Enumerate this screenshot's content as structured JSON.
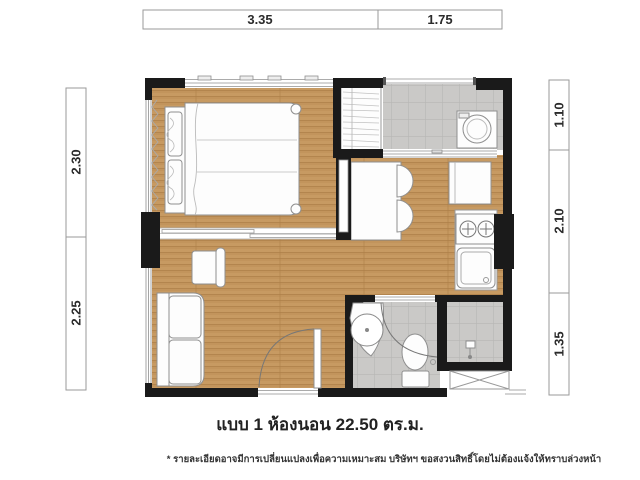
{
  "plan": {
    "title": "แบบ 1 ห้องนอน 22.50 ตร.ม.",
    "disclaimer": "* รายละเอียดอาจมีการเปลี่ยนแปลงเพื่อความเหมาะสม บริษัทฯ ขอสงวนสิทธิ์โดยไม่ต้องแจ้งให้ทราบล่วงหน้า"
  },
  "dimensions": {
    "top": [
      {
        "label": "3.35"
      },
      {
        "label": "1.75"
      }
    ],
    "left": [
      {
        "label": "2.30"
      },
      {
        "label": "2.25"
      }
    ],
    "right": [
      {
        "label": "1.10"
      },
      {
        "label": "2.10"
      },
      {
        "label": "1.35"
      }
    ]
  },
  "fixtures": {
    "bedroom": "bed-with-headboard-and-pillows",
    "wardrobe": "wardrobe",
    "balcony": "washing-machine",
    "kitchen": [
      "dining-table",
      "chairs",
      "refrigerator",
      "stove-2-burner",
      "sink"
    ],
    "living": [
      "sofa",
      "armchair",
      "entrance-door"
    ],
    "bathroom": [
      "basin",
      "toilet",
      "shower",
      "bathroom-door"
    ],
    "exterior": "ac-ledge"
  },
  "colors": {
    "wall": "#1a1a1a",
    "wood_floor": "#c2945c",
    "wood_line": "#b3854e",
    "tile_floor": "#cac9c7",
    "tile_line": "#b7b6b4",
    "furniture_fill": "#fdfdfd",
    "furniture_stroke": "#8f8f8f",
    "dim_border": "#9a9a9a",
    "text": "#2b2b2b"
  }
}
